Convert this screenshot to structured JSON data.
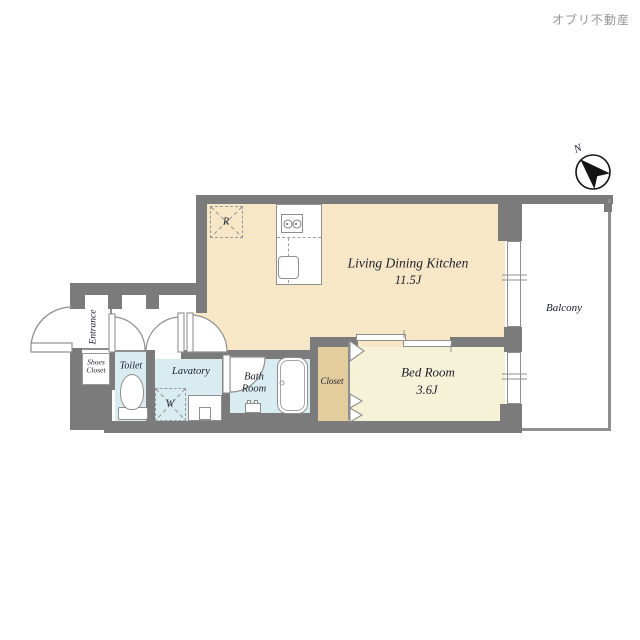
{
  "brand": "オブリ不動産",
  "compass": {
    "north_label": "N"
  },
  "rooms": {
    "ldk": {
      "name": "Living Dining Kitchen",
      "size": "11.5J"
    },
    "bedroom": {
      "name": "Bed Room",
      "size": "3.6J"
    },
    "balcony": {
      "name": "Balcony"
    },
    "entrance": {
      "name": "Entrance"
    },
    "shoes_closet": {
      "line1": "Shoes",
      "line2": "Closet"
    },
    "toilet": {
      "name": "Toilet"
    },
    "lavatory": {
      "name": "Lavatory"
    },
    "bath": {
      "line1": "Bath",
      "line2": "Room"
    },
    "closet": {
      "name": "Closet"
    }
  },
  "fixtures": {
    "refrigerator_mark": "R",
    "washer_mark": "W"
  },
  "palette": {
    "wall": "#7b7b7b",
    "ldk_floor": "#f8e7c7",
    "bedroom_floor": "#f6f2d8",
    "wet_room_floor": "#d9ecf2",
    "closet_floor": "#e4cd9d",
    "fixture_line": "#8f8f8f",
    "label_text": "#20212f",
    "brand_text": "#969696"
  }
}
